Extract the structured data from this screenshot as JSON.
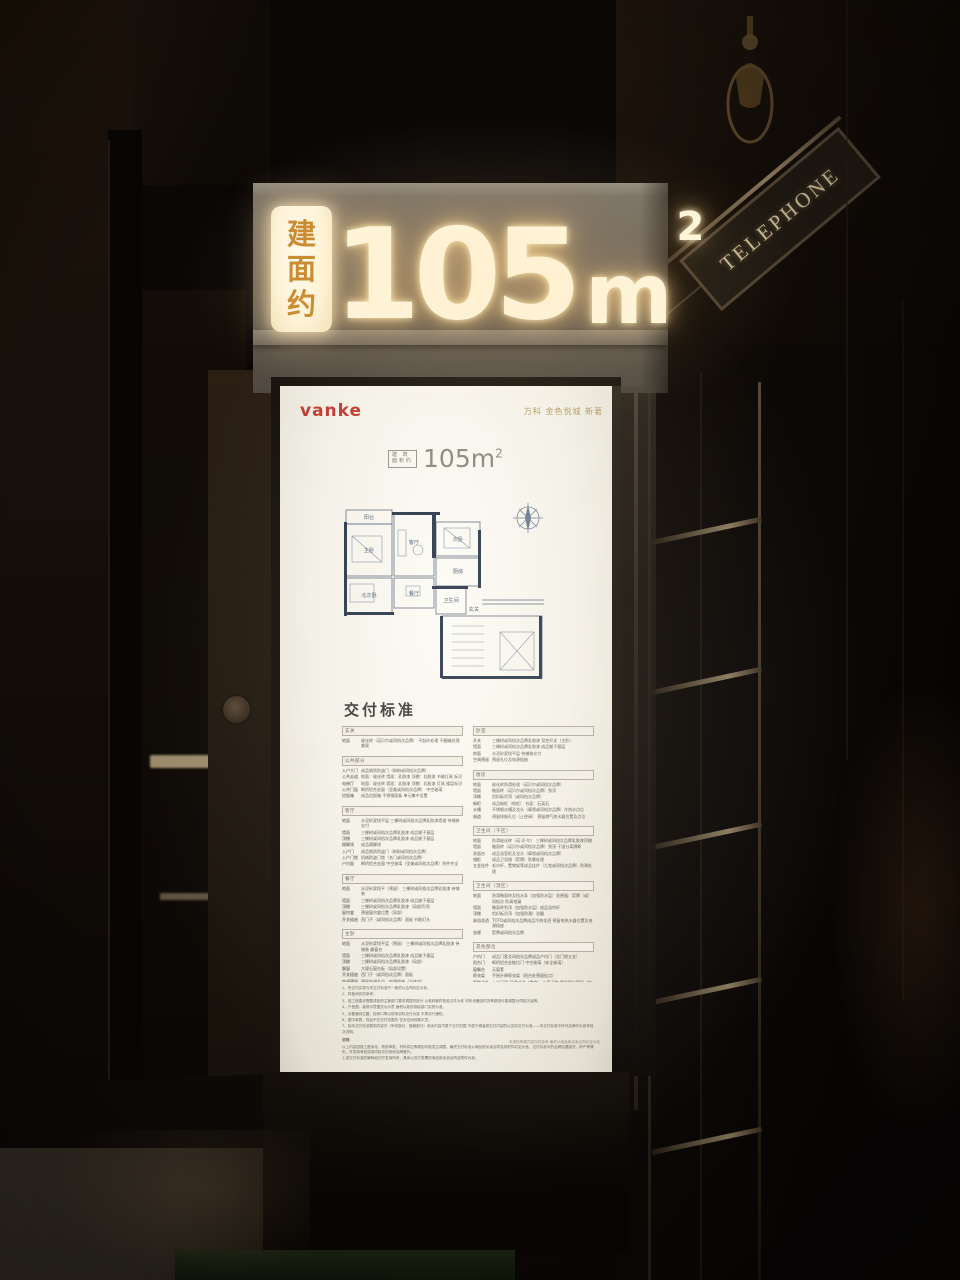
{
  "sign": {
    "prefix_chars": [
      "建",
      "面",
      "约"
    ],
    "area_value": "105",
    "area_unit": "m",
    "area_sup": "2"
  },
  "booth": {
    "sign_text": "TELEPHONE"
  },
  "poster": {
    "brand": "vanke",
    "project": "万科 金色悦城 新著",
    "area_label_lines": [
      "建 筑",
      "面积约"
    ],
    "area_value": "105m",
    "area_sup": "2",
    "floorplan": {
      "rooms": [
        "阳台",
        "主卧",
        "客厅",
        "次卧",
        "餐厅",
        "北次卧",
        "厨房",
        "卫生间",
        "玄关"
      ]
    },
    "delivery": {
      "title": "交付标准",
      "left_sections": [
        {
          "title": "玄关",
          "rows": [
            {
              "label": "地面",
              "text": "玻化砖（诺贝尔或同档次品牌） 不起砂处理 不翻碱处理 美观"
            }
          ]
        },
        {
          "title": "公共部分",
          "rows": [
            {
              "label": "入户大门",
              "text": "成品钢质防盗门（盼盼或同档次品牌）"
            },
            {
              "label": "公共走道",
              "text": "地面：玻化砖 墙面：乳胶漆 顶棚：乳胶漆 节能灯具 标识"
            },
            {
              "label": "电梯厅",
              "text": "地面：玻化砖 墙面：乳胶漆 顶棚：乳胶漆 灯具 楼层标识"
            },
            {
              "label": "公共门窗",
              "text": "断桥铝合金窗（坚美或同档次品牌） 中空玻璃"
            },
            {
              "label": "信报箱",
              "text": "成品信报箱 不锈钢面板 单元集中设置"
            }
          ]
        },
        {
          "title": "客厅",
          "rows": [
            {
              "label": "地面",
              "text": "水泥砂浆找平层 三棵树或同档次品牌乳胶漆墙裙 待铺装交付"
            },
            {
              "label": "墙面",
              "text": "三棵树或同档次品牌乳胶漆 成品腻子基层"
            },
            {
              "label": "顶棚",
              "text": "三棵树或同档次品牌乳胶漆 成品腻子基层"
            },
            {
              "label": "踢脚线",
              "text": "成品踢脚线"
            },
            {
              "label": "入户门",
              "text": "成品钢质防盗门（盼盼或同档次品牌）"
            },
            {
              "label": "入户门锁",
              "text": "机械防盗门锁（名门或同档次品牌）"
            },
            {
              "label": "户内窗",
              "text": "断桥铝合金窗 中空玻璃（坚美或同档次品牌）附件齐全"
            }
          ]
        },
        {
          "title": "餐厅",
          "rows": [
            {
              "label": "地面",
              "text": "水泥砂浆找平（预留） 三棵树或同档次品牌乳胶漆 待铺装"
            },
            {
              "label": "墙面",
              "text": "三棵树或同档次品牌乳胶漆 成品腻子基层"
            },
            {
              "label": "顶棚",
              "text": "三棵树或同档次品牌乳胶漆（局部吊顶）"
            },
            {
              "label": "窗帘盒",
              "text": "预留窗帘盒位置（局部）"
            },
            {
              "label": "开关插座",
              "text": "西门子（或同档次品牌）面板 节能灯头"
            }
          ]
        },
        {
          "title": "主卧",
          "rows": [
            {
              "label": "地面",
              "text": "水泥砂浆找平层（预留） 三棵树或同档次品牌乳胶漆 待铺装 飘窗台"
            },
            {
              "label": "墙面",
              "text": "三棵树或同档次品牌乳胶漆 成品腻子基层"
            },
            {
              "label": "顶棚",
              "text": "三棵树或同档次品牌乳胶漆（局部）"
            },
            {
              "label": "飘窗",
              "text": "大理石窗台板（局部设置）"
            },
            {
              "label": "开关插座",
              "text": "西门子（或同档次品牌）面板"
            },
            {
              "label": "空调预留",
              "text": "预留空调孔位、电源插座（分体机）"
            }
          ]
        },
        {
          "title": "次卧",
          "rows": [
            {
              "label": "地面",
              "text": "水泥砂浆找平层 待铺装交付 乳胶漆墙面"
            },
            {
              "label": "墙面",
              "text": "三棵树或同档次品牌乳胶漆 成品腻子基层"
            },
            {
              "label": "顶棚",
              "text": "三棵树或同档次品牌乳胶漆"
            },
            {
              "label": "开关插座",
              "text": "西门子（或同档次品牌）面板"
            }
          ]
        }
      ],
      "right_sections": [
        {
          "title": "卧室",
          "rows": [
            {
              "label": "开关",
              "text": "三棵树或同档次品牌乳胶漆 双控开关（主卧）"
            },
            {
              "label": "墙面",
              "text": "三棵树或同档次品牌乳胶漆 成品腻子基层"
            },
            {
              "label": "地面",
              "text": "水泥砂浆找平层 待铺装交付"
            },
            {
              "label": "空调预留",
              "text": "预留孔位及电源插座"
            }
          ]
        },
        {
          "title": "厨房",
          "rows": [
            {
              "label": "地面",
              "text": "玻化砖防滑处理（诺贝尔或同档次品牌）"
            },
            {
              "label": "墙面",
              "text": "釉面砖（诺贝尔或同档次品牌）到顶"
            },
            {
              "label": "顶棚",
              "text": "铝扣板吊顶（或同档次品牌）"
            },
            {
              "label": "橱柜",
              "text": "成品橱柜（地柜） 台面：石英石"
            },
            {
              "label": "水槽",
              "text": "不锈钢水槽及龙头（摩恩或同档次品牌）冷热水点位"
            },
            {
              "label": "烟道",
              "text": "预留排烟孔位（止逆阀） 预留燃气热水器位置及点位"
            }
          ]
        },
        {
          "title": "卫生间（干区）",
          "rows": [
            {
              "label": "地面",
              "text": "防滑玻化砖（诺·贝·尔） 三棵树或同档次品牌乳胶漆顶棚"
            },
            {
              "label": "墙面",
              "text": "釉面砖（诺贝尔或同档次品牌）到顶 干湿分离隔断"
            },
            {
              "label": "洗面台",
              "text": "成品浴室柜及龙头（摩恩或同档次品牌）"
            },
            {
              "label": "镜柜",
              "text": "成品卫浴镜（箭牌）防雾处理"
            },
            {
              "label": "五金挂件",
              "text": "毛巾杆、置物架等成品挂件（九牧或同档次品牌）防潮处理"
            }
          ]
        },
        {
          "title": "卫生间（湿区）",
          "rows": [
            {
              "label": "地面",
              "text": "防滑釉面砖及挡水条（加强防水层）坐便器：箭牌（或）同档次 防臭地漏"
            },
            {
              "label": "墙面",
              "text": "釉面砖到顶（加强防水层）成品浴帘杆"
            },
            {
              "label": "顶棚",
              "text": "铝扣板吊顶（加强防潮）浴霸"
            },
            {
              "label": "淋浴花洒",
              "text": "TOTO或同档次品牌成品冷热花洒 预留电热水器位置及电源插座"
            },
            {
              "label": "坐便",
              "text": "箭牌或同档次品牌"
            }
          ]
        },
        {
          "title": "其他部位",
          "rows": [
            {
              "label": "户内门",
              "text": "成品门套及同档次品牌成品户内门（含门锁五金）"
            },
            {
              "label": "阳台门",
              "text": "断桥铝合金推拉门 中空玻璃（安全玻璃）"
            },
            {
              "label": "窗飘台",
              "text": "无窗套"
            },
            {
              "label": "晾衣架",
              "text": "手摇升降晾衣架（阳台处预留挂点）"
            },
            {
              "label": "智能化系统",
              "text": "入户门磁 可视对讲（楼宇） 三表远传 宽带到户预留（电信/联通/移动 光纤入户）等电位端子箱"
            },
            {
              "label": "采暖",
              "text": "地板辐射采暖系统（分集水器） 预留壁挂炉位置及燃气点位"
            }
          ]
        }
      ],
      "notes": [
        "1、所交付实物与本交付标准不一致的以合同约定为准。",
        "2、样板间仅供参考。",
        "3、因工程建设需要或政府主管部门要求调整的部分 以政府最终批准文件为准 材料设备因供货等原因可能调整为同档次品牌。",
        "4、户型图、装修示意图仅为示意 面积以政府测绘部门实测为准。",
        "5、设备管线位置、检修口等以现场实际交付为准 不再另行通知。",
        "6、图中家具、饰品不在交付范围内 仅为空间效果示意。",
        "7、除本交付标准载明内容外（甲供部分、隐蔽部分）其余内容不属于交付范围 不属于精装修交付内容的以实际交付为准——本交付标准中所列品牌均为参考档次说明。"
      ],
      "notes_title": "说明：",
      "note_paragraph": [
        "以上内容因施工图深化、政府审批、材料供应等原因可能发生调整，最终交付标准以商品房买卖合同及其附件约定为准。交付标准中的品牌如遇缺货、停产等情形，开发商有权选用同档次的其他品牌替代。",
        "上述交付标准的解释权归开发商所有，具体以双方签署的商品房买卖合同及附件为准。"
      ],
      "footer": "本资料所载内容仅供参考 最终以商品房买卖合同约定为准"
    }
  }
}
